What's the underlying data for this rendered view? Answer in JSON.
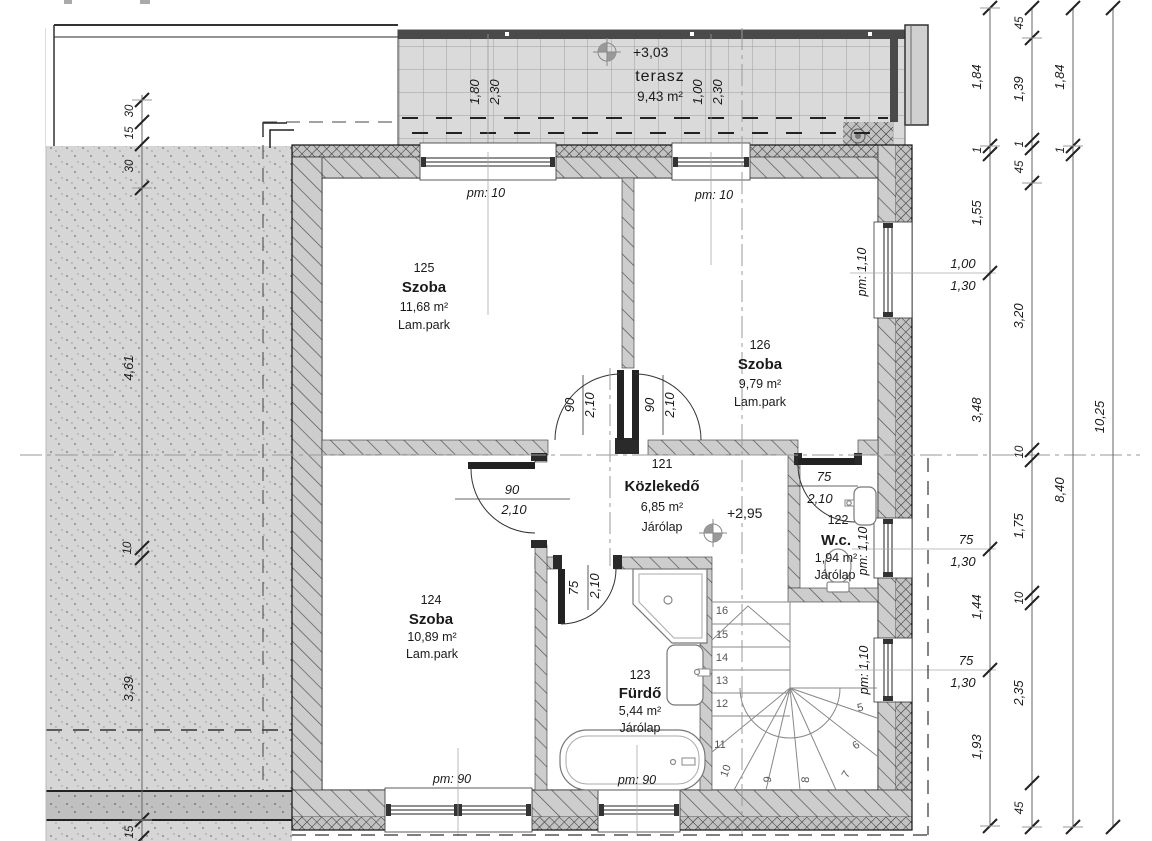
{
  "terrace": {
    "name": "terasz",
    "area": "9,43 m²",
    "level": "+3,03",
    "win1_w": "1,80",
    "win1_h": "2,30",
    "win2_w": "1,00",
    "win2_h": "2,30"
  },
  "hall_level": "+2,95",
  "rooms": {
    "r125": {
      "number": "125",
      "name": "Szoba",
      "area": "11,68 m²",
      "floor": "Lam.park"
    },
    "r126": {
      "number": "126",
      "name": "Szoba",
      "area": "9,79 m²",
      "floor": "Lam.park"
    },
    "r121": {
      "number": "121",
      "name": "Közlekedő",
      "area": "6,85 m²",
      "floor": "Járólap"
    },
    "r122": {
      "number": "122",
      "name": "W.c.",
      "area": "1,94 m²",
      "floor": "Járólap"
    },
    "r124": {
      "number": "124",
      "name": "Szoba",
      "area": "10,89 m²",
      "floor": "Lam.park"
    },
    "r123": {
      "number": "123",
      "name": "Fürdő",
      "area": "5,44 m²",
      "floor": "Járólap"
    }
  },
  "labels": {
    "pm10": "pm: 10",
    "pm110": "pm: 1,10",
    "pm90": "pm: 90"
  },
  "doors": {
    "d90w": "90",
    "d90h": "2,10",
    "d75w": "75",
    "d75h": "2,10"
  },
  "win_right": {
    "a_w": "1,00",
    "a_h": "1,30",
    "b_w": "75",
    "b_h": "1,30",
    "c_w": "75",
    "c_h": "1,30"
  },
  "dims": {
    "right1": [
      "1,84",
      "1",
      "1,55",
      "3,48",
      "1,44",
      "1,93"
    ],
    "right2": [
      "45",
      "1,39",
      "1",
      "45",
      "3,20",
      "10",
      "1,75",
      "10",
      "2,35",
      "45"
    ],
    "right3": [
      "1,84",
      "1",
      "8,40"
    ],
    "right4": [
      "10,25"
    ],
    "left": [
      "30",
      "15",
      "30",
      "4,61",
      "10",
      "3,39",
      "15"
    ]
  },
  "stairs": [
    "5",
    "6",
    "7",
    "8",
    "9",
    "10",
    "11",
    "12",
    "13",
    "14",
    "15",
    "16"
  ]
}
